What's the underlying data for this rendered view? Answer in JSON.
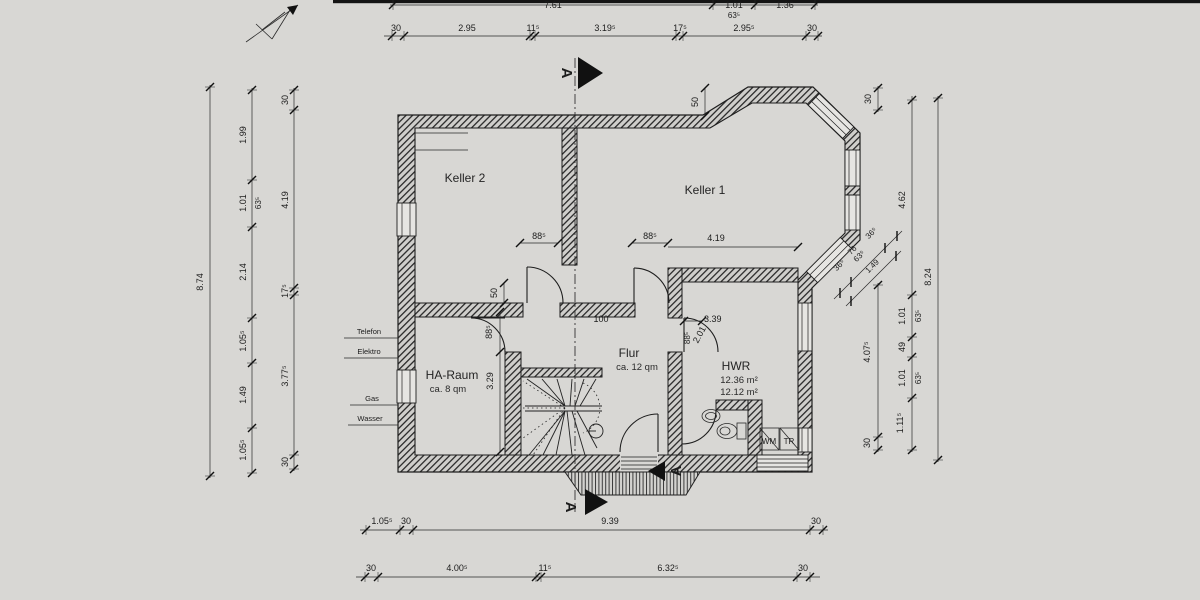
{
  "drawing": {
    "rooms": {
      "keller2": {
        "name": "Keller 2"
      },
      "keller1": {
        "name": "Keller 1"
      },
      "ha_raum": {
        "name": "HA-Raum",
        "area": "ca. 8 qm"
      },
      "flur": {
        "name": "Flur",
        "area": "ca. 12 qm"
      },
      "hwr": {
        "name": "HWR",
        "area_1": "12.36 m²",
        "area_2": "12.12 m²"
      }
    },
    "appliances": {
      "washer": "WM",
      "dryer": "TR"
    },
    "utilities": {
      "telefon": "Telefon",
      "elektro": "Elektro",
      "gas": "Gas",
      "wasser": "Wasser"
    },
    "section": {
      "letter": "A"
    },
    "dims": {
      "top_outer": [
        "7.61",
        "1.01",
        "63⁵",
        "1.36"
      ],
      "top_inner": [
        "30",
        "2.95",
        "11⁵",
        "3.19⁵",
        "17⁵",
        "2.95⁵",
        "30"
      ],
      "left_total": [
        "8.74"
      ],
      "left_mid": [
        "1.99",
        "1.01",
        "63⁵",
        "2.14",
        "1.05⁵",
        "1.49",
        "1.05⁵"
      ],
      "left_inner": [
        "30",
        "4.19",
        "17⁵",
        "3.77⁵",
        "30"
      ],
      "right_total": [
        "8.24"
      ],
      "right_mid": [
        "4.62",
        "1.01",
        "63⁵",
        "49",
        "1.01",
        "63⁵",
        "1.11⁵"
      ],
      "right_inner": [
        "30",
        "4.07⁵",
        "30"
      ],
      "bay": [
        "36⁵",
        "76",
        "36⁵",
        "63⁵",
        "1.49"
      ],
      "bottom_outer": [
        "1.05⁵",
        "30",
        "9.39",
        "30"
      ],
      "bottom_inner": [
        "30",
        "4.00⁵",
        "11⁵",
        "6.32⁵",
        "30"
      ],
      "interior": {
        "keller2_door": "88⁵",
        "keller1_door": "88⁵",
        "keller1_wall": "4.19",
        "bay_step": "50",
        "wall_offset": "50",
        "ha_door": "88⁵",
        "ha_wall": "3.29",
        "stair_opening": "100",
        "hwr_width": "3.39",
        "hwr_diag": "2.01",
        "hwr_door": "88⁵"
      }
    }
  }
}
